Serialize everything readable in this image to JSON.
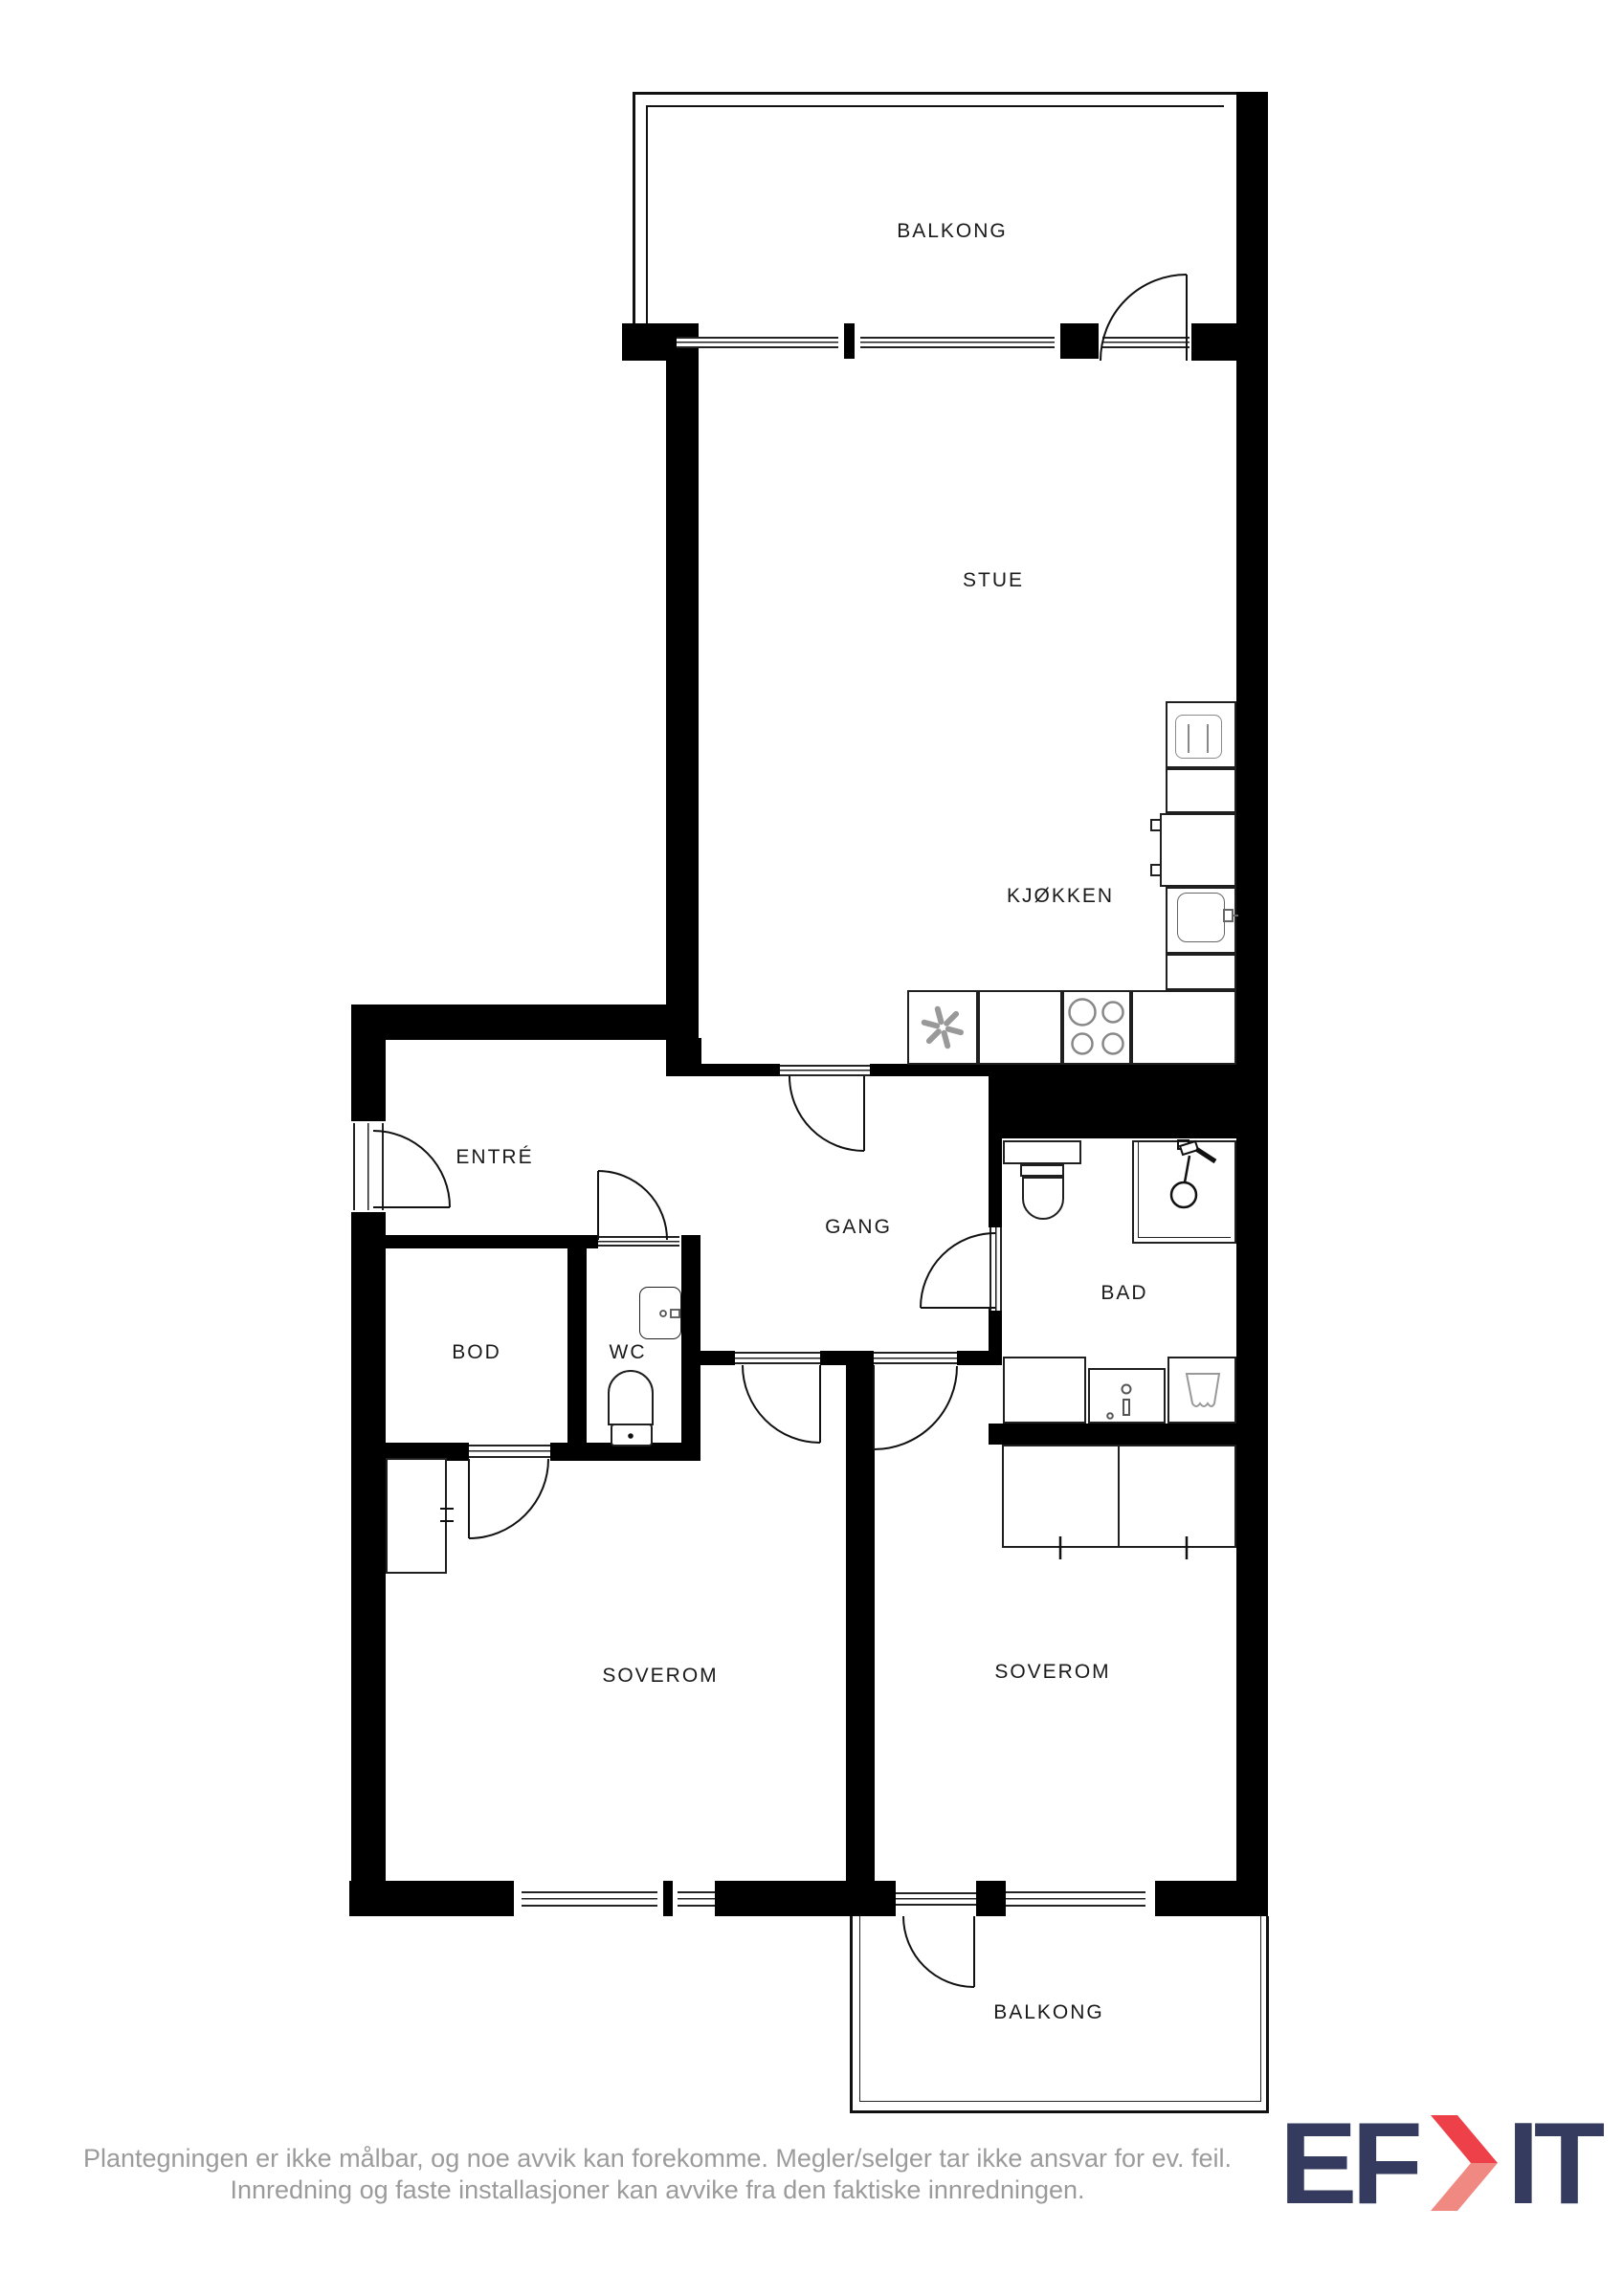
{
  "rooms": [
    {
      "id": "balkong-top",
      "label": "BALKONG"
    },
    {
      "id": "stue",
      "label": "STUE"
    },
    {
      "id": "kjokken",
      "label": "KJØKKEN"
    },
    {
      "id": "entre",
      "label": "ENTRÉ"
    },
    {
      "id": "gang",
      "label": "GANG"
    },
    {
      "id": "bad",
      "label": "BAD"
    },
    {
      "id": "bod",
      "label": "BOD"
    },
    {
      "id": "wc",
      "label": "WC"
    },
    {
      "id": "soverom-left",
      "label": "SOVEROM"
    },
    {
      "id": "soverom-right",
      "label": "SOVEROM"
    },
    {
      "id": "balkong-bottom",
      "label": "BALKONG"
    }
  ],
  "disclaimer": {
    "line1": "Plantegningen er ikke målbar, og noe avvik kan forekomme. Megler/selger tar ikke ansvar for ev. feil.",
    "line2": "Innredning og faste installasjoner kan avvike fra den faktiske innredningen."
  },
  "logo": {
    "left": "EF",
    "right": "IT",
    "chevron_icon": "logo-chevron-icon"
  },
  "icons": [
    "extractor-fan-icon",
    "stove-burners-icon",
    "kitchen-sink-icon",
    "dishwasher-icon",
    "shower-icon",
    "toilet-icon",
    "bathroom-sink-icon",
    "washing-machine-icon",
    "wc-sink-icon",
    "wc-toilet-icon",
    "wardrobe-icon",
    "closet-icon",
    "door-swing-icon"
  ],
  "colors": {
    "wall": "#000000",
    "line": "#1a1a1a",
    "fixture_line": "#8a8a8a",
    "label_text": "#1a1a1a",
    "disclaimer_text": "#9b9b9b",
    "logo_navy": "#353b5e",
    "logo_red": "#ee4049",
    "logo_salmon": "#f18983"
  }
}
